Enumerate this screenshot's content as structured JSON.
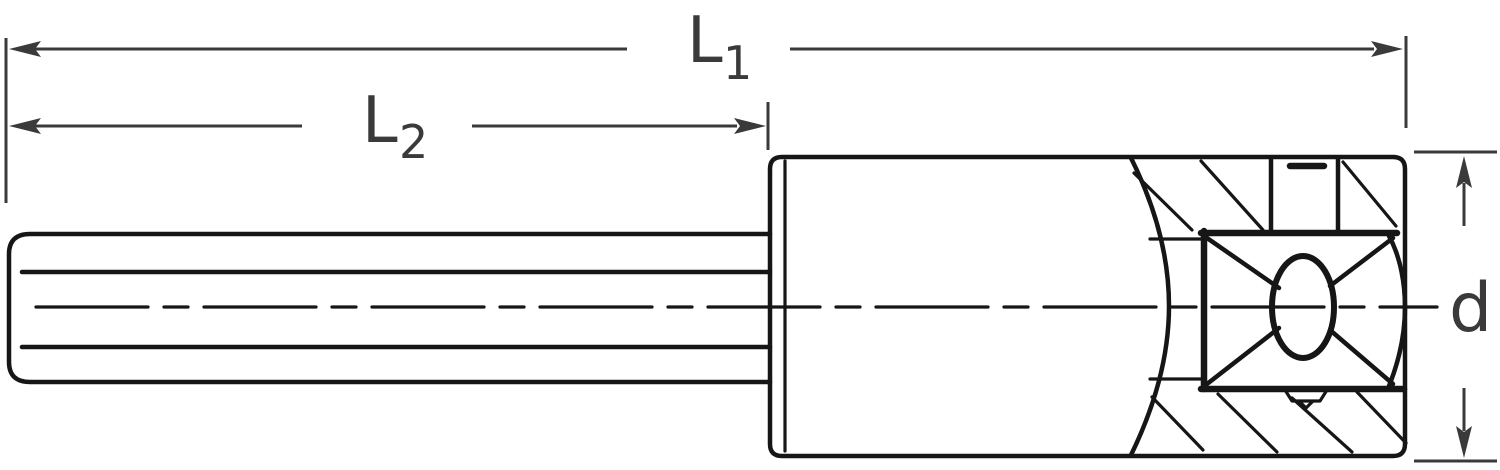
{
  "drawing": {
    "labels": {
      "l1": {
        "base": "L",
        "sub": "1"
      },
      "l2": {
        "base": "L",
        "sub": "2"
      },
      "d": {
        "base": "d"
      }
    },
    "colors": {
      "line": "#161616",
      "dimension": "#3a3a3a",
      "background": "#ffffff"
    }
  }
}
